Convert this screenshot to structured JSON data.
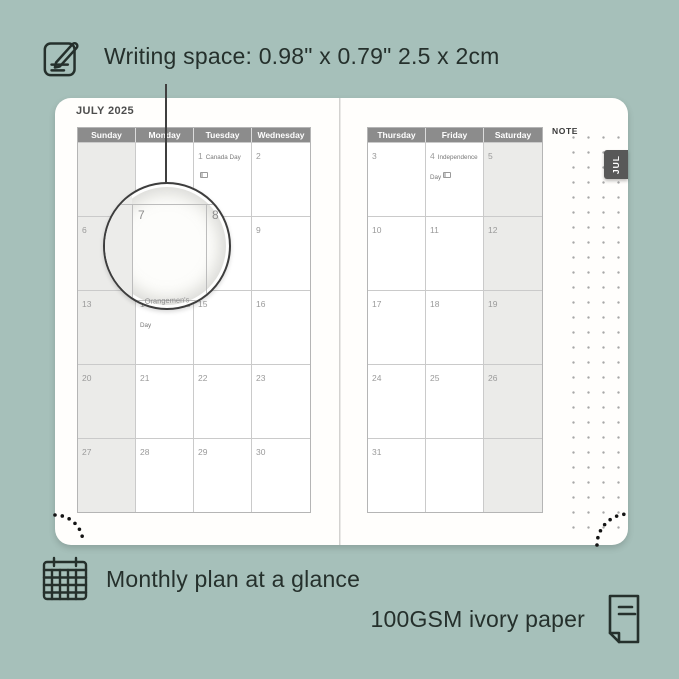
{
  "colors": {
    "background": "#a6c0ba",
    "text_dark": "#25302c",
    "page": "#fffefc",
    "calendar_header_bg": "#8c8c8c",
    "weekend_shade": "#ebebe9",
    "grid_line": "#cacaca",
    "day_number": "#9a9a9a",
    "month_tab_bg": "#585858",
    "note_dot": "#a8a8a8"
  },
  "icons": {
    "pencil_note": "pencil-note-icon",
    "calendar_grid": "calendar-grid-icon",
    "paper_sheet": "paper-sheet-icon",
    "flag": "flag-icon"
  },
  "features": {
    "writing_space": {
      "label": "Writing space: 0.98\" x 0.79\" 2.5 x 2cm"
    },
    "monthly_plan": {
      "label": "Monthly plan at a glance"
    },
    "paper": {
      "label": "100GSM ivory paper"
    }
  },
  "planner": {
    "month_title": "JULY 2025",
    "month_tab": "JUL",
    "note_label": "NOTE",
    "left_page": {
      "day_headers": [
        "Sunday",
        "Monday",
        "Tuesday",
        "Wednesday"
      ],
      "shaded_column": 0,
      "cells": [
        {
          "day": ""
        },
        {
          "day": ""
        },
        {
          "day": "1",
          "holiday": "Canada Day",
          "flag": true
        },
        {
          "day": "2"
        },
        {
          "day": "6"
        },
        {
          "day": "7"
        },
        {
          "day": "8"
        },
        {
          "day": "9"
        },
        {
          "day": "13"
        },
        {
          "day": "14",
          "holiday": "Orangemen's Day"
        },
        {
          "day": "15"
        },
        {
          "day": "16"
        },
        {
          "day": "20"
        },
        {
          "day": "21"
        },
        {
          "day": "22"
        },
        {
          "day": "23"
        },
        {
          "day": "27"
        },
        {
          "day": "28"
        },
        {
          "day": "29"
        },
        {
          "day": "30"
        }
      ]
    },
    "right_page": {
      "day_headers": [
        "Thursday",
        "Friday",
        "Saturday"
      ],
      "shaded_column": 2,
      "cells": [
        {
          "day": "3"
        },
        {
          "day": "4",
          "holiday": "Independence Day",
          "flag": true
        },
        {
          "day": "5"
        },
        {
          "day": "10"
        },
        {
          "day": "11"
        },
        {
          "day": "12"
        },
        {
          "day": "17"
        },
        {
          "day": "18"
        },
        {
          "day": "19"
        },
        {
          "day": "24"
        },
        {
          "day": "25"
        },
        {
          "day": "26"
        },
        {
          "day": "31"
        },
        {
          "day": ""
        },
        {
          "day": ""
        }
      ]
    }
  },
  "magnifier": {
    "left_day": "7",
    "right_day": "8",
    "caption": "Orangemen's"
  }
}
